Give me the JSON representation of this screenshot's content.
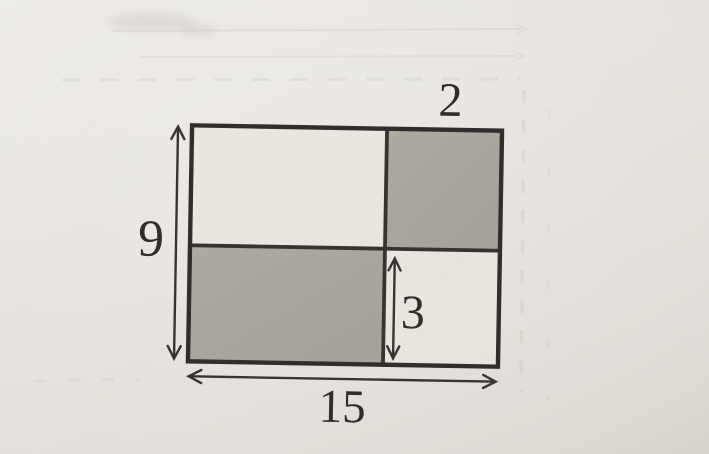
{
  "figure": {
    "kind": "rectangle divided into four cells by one vertical and one horizontal line",
    "shaded_cells": [
      "top-right",
      "bottom-left"
    ],
    "dimension_labels": {
      "total_height": "9",
      "total_width": "15",
      "right_section": "2",
      "inner_height": "3"
    },
    "colors": {
      "paper": "#e8e5e0",
      "shaded_fill": "#a9a59e",
      "cell_fill": "#eae7e1",
      "line": "#2f2d29"
    }
  }
}
